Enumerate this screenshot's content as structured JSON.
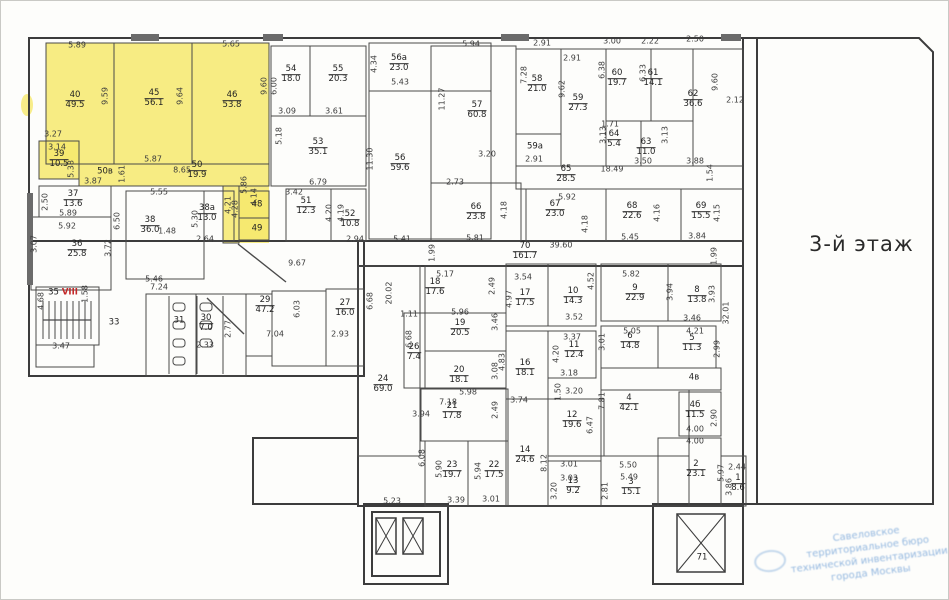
{
  "floor_title": "3-й этаж",
  "stamp": {
    "lines": [
      "Савеловское",
      "территориальное бюро",
      "технической инвентаризации",
      "города Москвы"
    ]
  },
  "highlight_color": "#f6e96d",
  "rooms": [
    {
      "number": "40",
      "area": "49.5",
      "x": 74,
      "y": 100
    },
    {
      "number": "45",
      "area": "56.1",
      "x": 153,
      "y": 98
    },
    {
      "number": "46",
      "area": "53.8",
      "x": 231,
      "y": 100
    },
    {
      "number": "39",
      "area": "10.5",
      "x": 58,
      "y": 159
    },
    {
      "number": "50в",
      "area": "",
      "x": 104,
      "y": 171
    },
    {
      "number": "50",
      "area": "19.9",
      "x": 196,
      "y": 170
    },
    {
      "number": "48",
      "area": "",
      "x": 256,
      "y": 204
    },
    {
      "number": "49",
      "area": "",
      "x": 256,
      "y": 228
    },
    {
      "number": "54",
      "area": "18.0",
      "x": 290,
      "y": 74
    },
    {
      "number": "55",
      "area": "20.3",
      "x": 337,
      "y": 74
    },
    {
      "number": "53",
      "area": "35.1",
      "x": 317,
      "y": 147
    },
    {
      "number": "56а",
      "area": "23.0",
      "x": 398,
      "y": 63
    },
    {
      "number": "56",
      "area": "59.6",
      "x": 399,
      "y": 163
    },
    {
      "number": "57",
      "area": "60.8",
      "x": 476,
      "y": 110
    },
    {
      "number": "58",
      "area": "21.0",
      "x": 536,
      "y": 84
    },
    {
      "number": "59а",
      "area": "",
      "x": 534,
      "y": 146
    },
    {
      "number": "59",
      "area": "27.3",
      "x": 577,
      "y": 103
    },
    {
      "number": "60",
      "area": "19.7",
      "x": 616,
      "y": 78
    },
    {
      "number": "61",
      "area": "14.1",
      "x": 652,
      "y": 78
    },
    {
      "number": "62",
      "area": "36.6",
      "x": 692,
      "y": 99
    },
    {
      "number": "64",
      "area": "5.4",
      "x": 613,
      "y": 139
    },
    {
      "number": "63",
      "area": "11.0",
      "x": 645,
      "y": 147
    },
    {
      "number": "65",
      "area": "28.5",
      "x": 565,
      "y": 174
    },
    {
      "number": "66",
      "area": "23.8",
      "x": 475,
      "y": 212
    },
    {
      "number": "67",
      "area": "23.0",
      "x": 554,
      "y": 209
    },
    {
      "number": "68",
      "area": "22.6",
      "x": 631,
      "y": 211
    },
    {
      "number": "69",
      "area": "15.5",
      "x": 700,
      "y": 211
    },
    {
      "number": "70",
      "area": "161.7",
      "x": 524,
      "y": 251
    },
    {
      "number": "51",
      "area": "12.3",
      "x": 305,
      "y": 206
    },
    {
      "number": "52",
      "area": "10.8",
      "x": 349,
      "y": 219
    },
    {
      "number": "37",
      "area": "13.6",
      "x": 72,
      "y": 199
    },
    {
      "number": "36",
      "area": "25.8",
      "x": 76,
      "y": 249
    },
    {
      "number": "38",
      "area": "36.0",
      "x": 149,
      "y": 225
    },
    {
      "number": "38а",
      "area": "13.0",
      "x": 206,
      "y": 213
    },
    {
      "number": "35",
      "suffix": "VIII",
      "area": "",
      "x": 62,
      "y": 292
    },
    {
      "number": "33",
      "area": "",
      "x": 113,
      "y": 322
    },
    {
      "number": "31",
      "area": "",
      "x": 178,
      "y": 320
    },
    {
      "number": "30",
      "area": "7.0",
      "x": 205,
      "y": 323
    },
    {
      "number": "29",
      "area": "47.2",
      "x": 264,
      "y": 305
    },
    {
      "number": "27",
      "area": "16.0",
      "x": 344,
      "y": 308
    },
    {
      "number": "24",
      "area": "69.0",
      "x": 382,
      "y": 384
    },
    {
      "number": "18",
      "area": "17.6",
      "x": 434,
      "y": 287
    },
    {
      "number": "19",
      "area": "20.5",
      "x": 459,
      "y": 328
    },
    {
      "number": "26",
      "area": "7.4",
      "x": 413,
      "y": 352
    },
    {
      "number": "20",
      "area": "18.1",
      "x": 458,
      "y": 375
    },
    {
      "number": "21",
      "area": "17.8",
      "x": 451,
      "y": 411
    },
    {
      "number": "17",
      "area": "17.5",
      "x": 524,
      "y": 298
    },
    {
      "number": "10",
      "area": "14.3",
      "x": 572,
      "y": 296
    },
    {
      "number": "9",
      "area": "22.9",
      "x": 634,
      "y": 293
    },
    {
      "number": "8",
      "area": "13.8",
      "x": 696,
      "y": 295
    },
    {
      "number": "16",
      "area": "18.1",
      "x": 524,
      "y": 368
    },
    {
      "number": "11",
      "area": "12.4",
      "x": 573,
      "y": 350
    },
    {
      "number": "6",
      "area": "14.8",
      "x": 629,
      "y": 341
    },
    {
      "number": "5",
      "area": "11.3",
      "x": 691,
      "y": 343
    },
    {
      "number": "4в",
      "area": "",
      "x": 693,
      "y": 377
    },
    {
      "number": "4",
      "area": "42.1",
      "x": 628,
      "y": 403
    },
    {
      "number": "4б",
      "area": "11.5",
      "x": 694,
      "y": 410
    },
    {
      "number": "12",
      "area": "19.6",
      "x": 571,
      "y": 420
    },
    {
      "number": "14",
      "area": "24.6",
      "x": 524,
      "y": 455
    },
    {
      "number": "23",
      "area": "19.7",
      "x": 451,
      "y": 470
    },
    {
      "number": "22",
      "area": "17.5",
      "x": 493,
      "y": 470
    },
    {
      "number": "13",
      "area": "9.2",
      "x": 572,
      "y": 486
    },
    {
      "number": "3",
      "area": "15.1",
      "x": 630,
      "y": 487
    },
    {
      "number": "2",
      "area": "23.1",
      "x": 695,
      "y": 469
    },
    {
      "number": "1",
      "area": "8.6",
      "x": 737,
      "y": 483
    },
    {
      "number": "71",
      "area": "",
      "x": 701,
      "y": 557
    }
  ],
  "dimensions": [
    {
      "text": "5.89",
      "x": 76,
      "y": 44,
      "vertical": false
    },
    {
      "text": "5.65",
      "x": 230,
      "y": 43,
      "vertical": false
    },
    {
      "text": "9.59",
      "x": 104,
      "y": 95,
      "vertical": true
    },
    {
      "text": "9.64",
      "x": 179,
      "y": 95,
      "vertical": true
    },
    {
      "text": "9.60",
      "x": 263,
      "y": 85,
      "vertical": true
    },
    {
      "text": "6.00",
      "x": 273,
      "y": 85,
      "vertical": true
    },
    {
      "text": "3.27",
      "x": 52,
      "y": 133,
      "vertical": false
    },
    {
      "text": "3.14",
      "x": 56,
      "y": 146,
      "vertical": false
    },
    {
      "text": "5.38",
      "x": 70,
      "y": 168,
      "vertical": true
    },
    {
      "text": "3.87",
      "x": 92,
      "y": 180,
      "vertical": false
    },
    {
      "text": "1.61",
      "x": 121,
      "y": 173,
      "vertical": true
    },
    {
      "text": "5.87",
      "x": 152,
      "y": 158,
      "vertical": false
    },
    {
      "text": "8.65",
      "x": 181,
      "y": 169,
      "vertical": false
    },
    {
      "text": "5.86",
      "x": 243,
      "y": 184,
      "vertical": true
    },
    {
      "text": "4.14",
      "x": 253,
      "y": 196,
      "vertical": true
    },
    {
      "text": "4.21",
      "x": 227,
      "y": 204,
      "vertical": true
    },
    {
      "text": "4.28",
      "x": 234,
      "y": 208,
      "vertical": true
    },
    {
      "text": "1.48",
      "x": 166,
      "y": 230,
      "vertical": false
    },
    {
      "text": "2.64",
      "x": 204,
      "y": 238,
      "vertical": false
    },
    {
      "text": "2.50",
      "x": 44,
      "y": 201,
      "vertical": true
    },
    {
      "text": "5.89",
      "x": 67,
      "y": 212,
      "vertical": false
    },
    {
      "text": "5.92",
      "x": 66,
      "y": 225,
      "vertical": false
    },
    {
      "text": "3.07",
      "x": 33,
      "y": 243,
      "vertical": true
    },
    {
      "text": "3.72",
      "x": 107,
      "y": 247,
      "vertical": true
    },
    {
      "text": "6.50",
      "x": 116,
      "y": 220,
      "vertical": true
    },
    {
      "text": "5.55",
      "x": 158,
      "y": 191,
      "vertical": false
    },
    {
      "text": "5.30",
      "x": 194,
      "y": 218,
      "vertical": true
    },
    {
      "text": "5.46",
      "x": 153,
      "y": 278,
      "vertical": false
    },
    {
      "text": "9.67",
      "x": 296,
      "y": 262,
      "vertical": false
    },
    {
      "text": "4.68",
      "x": 40,
      "y": 300,
      "vertical": true
    },
    {
      "text": "1.58",
      "x": 84,
      "y": 293,
      "vertical": true
    },
    {
      "text": "7.24",
      "x": 158,
      "y": 286,
      "vertical": false
    },
    {
      "text": "3.47",
      "x": 60,
      "y": 345,
      "vertical": false
    },
    {
      "text": "2.33",
      "x": 204,
      "y": 344,
      "vertical": false
    },
    {
      "text": "2.77",
      "x": 227,
      "y": 328,
      "vertical": true
    },
    {
      "text": "7.04",
      "x": 274,
      "y": 333,
      "vertical": false
    },
    {
      "text": "6.03",
      "x": 296,
      "y": 308,
      "vertical": true
    },
    {
      "text": "2.93",
      "x": 339,
      "y": 333,
      "vertical": false
    },
    {
      "text": "3.09",
      "x": 286,
      "y": 110,
      "vertical": false
    },
    {
      "text": "3.61",
      "x": 333,
      "y": 110,
      "vertical": false
    },
    {
      "text": "5.18",
      "x": 278,
      "y": 135,
      "vertical": true
    },
    {
      "text": "6.79",
      "x": 317,
      "y": 181,
      "vertical": false
    },
    {
      "text": "3.42",
      "x": 293,
      "y": 191,
      "vertical": false
    },
    {
      "text": "4.20",
      "x": 328,
      "y": 212,
      "vertical": true
    },
    {
      "text": "4.19",
      "x": 340,
      "y": 212,
      "vertical": true
    },
    {
      "text": "2.94",
      "x": 354,
      "y": 238,
      "vertical": false
    },
    {
      "text": "5.41",
      "x": 401,
      "y": 238,
      "vertical": false
    },
    {
      "text": "4.34",
      "x": 373,
      "y": 63,
      "vertical": true
    },
    {
      "text": "5.43",
      "x": 399,
      "y": 81,
      "vertical": false
    },
    {
      "text": "5.94",
      "x": 470,
      "y": 43,
      "vertical": false
    },
    {
      "text": "11.27",
      "x": 441,
      "y": 98,
      "vertical": true
    },
    {
      "text": "11.30",
      "x": 369,
      "y": 158,
      "vertical": true
    },
    {
      "text": "3.20",
      "x": 486,
      "y": 153,
      "vertical": false
    },
    {
      "text": "2.73",
      "x": 454,
      "y": 181,
      "vertical": false
    },
    {
      "text": "5.92",
      "x": 566,
      "y": 196,
      "vertical": false
    },
    {
      "text": "2.91",
      "x": 541,
      "y": 42,
      "vertical": false
    },
    {
      "text": "3.00",
      "x": 611,
      "y": 40,
      "vertical": false
    },
    {
      "text": "2.22",
      "x": 649,
      "y": 40,
      "vertical": false
    },
    {
      "text": "2.50",
      "x": 694,
      "y": 38,
      "vertical": false
    },
    {
      "text": "2.91",
      "x": 571,
      "y": 57,
      "vertical": false
    },
    {
      "text": "7.28",
      "x": 523,
      "y": 74,
      "vertical": true
    },
    {
      "text": "9.62",
      "x": 561,
      "y": 88,
      "vertical": true
    },
    {
      "text": "6.38",
      "x": 601,
      "y": 69,
      "vertical": true
    },
    {
      "text": "6.33",
      "x": 642,
      "y": 72,
      "vertical": true
    },
    {
      "text": "9.60",
      "x": 714,
      "y": 81,
      "vertical": true
    },
    {
      "text": "2.91",
      "x": 533,
      "y": 158,
      "vertical": false
    },
    {
      "text": "1.71",
      "x": 609,
      "y": 123,
      "vertical": false
    },
    {
      "text": "3.13",
      "x": 602,
      "y": 134,
      "vertical": true
    },
    {
      "text": "3.13",
      "x": 664,
      "y": 134,
      "vertical": true
    },
    {
      "text": "3.50",
      "x": 642,
      "y": 160,
      "vertical": false
    },
    {
      "text": "3.88",
      "x": 694,
      "y": 160,
      "vertical": false
    },
    {
      "text": "1.54",
      "x": 709,
      "y": 172,
      "vertical": true
    },
    {
      "text": "18.49",
      "x": 611,
      "y": 168,
      "vertical": false
    },
    {
      "text": "5.81",
      "x": 474,
      "y": 237,
      "vertical": false
    },
    {
      "text": "4.18",
      "x": 503,
      "y": 209,
      "vertical": true
    },
    {
      "text": "4.18",
      "x": 584,
      "y": 223,
      "vertical": true
    },
    {
      "text": "5.45",
      "x": 629,
      "y": 236,
      "vertical": false
    },
    {
      "text": "4.16",
      "x": 656,
      "y": 212,
      "vertical": true
    },
    {
      "text": "3.84",
      "x": 696,
      "y": 235,
      "vertical": false
    },
    {
      "text": "4.15",
      "x": 716,
      "y": 212,
      "vertical": true
    },
    {
      "text": "39.60",
      "x": 560,
      "y": 244,
      "vertical": false
    },
    {
      "text": "1.99",
      "x": 431,
      "y": 252,
      "vertical": true
    },
    {
      "text": "1.99",
      "x": 713,
      "y": 255,
      "vertical": true
    },
    {
      "text": "2.12",
      "x": 734,
      "y": 99,
      "vertical": false
    },
    {
      "text": "20.02",
      "x": 388,
      "y": 292,
      "vertical": true
    },
    {
      "text": "6.68",
      "x": 369,
      "y": 300,
      "vertical": true
    },
    {
      "text": "5.17",
      "x": 444,
      "y": 273,
      "vertical": false
    },
    {
      "text": "2.49",
      "x": 491,
      "y": 285,
      "vertical": true
    },
    {
      "text": "3.54",
      "x": 522,
      "y": 276,
      "vertical": false
    },
    {
      "text": "4.97",
      "x": 508,
      "y": 298,
      "vertical": true
    },
    {
      "text": "1.11",
      "x": 408,
      "y": 313,
      "vertical": false
    },
    {
      "text": "5.96",
      "x": 459,
      "y": 311,
      "vertical": false
    },
    {
      "text": "3.46",
      "x": 494,
      "y": 321,
      "vertical": true
    },
    {
      "text": "6.68",
      "x": 408,
      "y": 338,
      "vertical": true
    },
    {
      "text": "3.08",
      "x": 494,
      "y": 370,
      "vertical": true
    },
    {
      "text": "4.83",
      "x": 501,
      "y": 361,
      "vertical": true
    },
    {
      "text": "5.98",
      "x": 467,
      "y": 391,
      "vertical": false
    },
    {
      "text": "7.18",
      "x": 447,
      "y": 401,
      "vertical": false
    },
    {
      "text": "2.49",
      "x": 494,
      "y": 409,
      "vertical": true
    },
    {
      "text": "3.74",
      "x": 518,
      "y": 399,
      "vertical": false
    },
    {
      "text": "5.82",
      "x": 630,
      "y": 273,
      "vertical": false
    },
    {
      "text": "4.52",
      "x": 590,
      "y": 280,
      "vertical": true
    },
    {
      "text": "3.94",
      "x": 669,
      "y": 291,
      "vertical": true
    },
    {
      "text": "3.93",
      "x": 711,
      "y": 293,
      "vertical": true
    },
    {
      "text": "3.46",
      "x": 691,
      "y": 317,
      "vertical": false
    },
    {
      "text": "3.52",
      "x": 573,
      "y": 316,
      "vertical": false
    },
    {
      "text": "3.37",
      "x": 571,
      "y": 336,
      "vertical": false
    },
    {
      "text": "4.20",
      "x": 555,
      "y": 353,
      "vertical": true
    },
    {
      "text": "3.18",
      "x": 568,
      "y": 372,
      "vertical": false
    },
    {
      "text": "3.20",
      "x": 573,
      "y": 390,
      "vertical": false
    },
    {
      "text": "1.50",
      "x": 557,
      "y": 391,
      "vertical": true
    },
    {
      "text": "5.05",
      "x": 631,
      "y": 330,
      "vertical": false
    },
    {
      "text": "3.01",
      "x": 601,
      "y": 341,
      "vertical": true
    },
    {
      "text": "4.21",
      "x": 694,
      "y": 330,
      "vertical": false
    },
    {
      "text": "2.99",
      "x": 716,
      "y": 348,
      "vertical": true
    },
    {
      "text": "32.01",
      "x": 725,
      "y": 312,
      "vertical": true
    },
    {
      "text": "7.81",
      "x": 601,
      "y": 400,
      "vertical": true
    },
    {
      "text": "2.90",
      "x": 713,
      "y": 417,
      "vertical": true
    },
    {
      "text": "4.00",
      "x": 694,
      "y": 428,
      "vertical": false
    },
    {
      "text": "4.00",
      "x": 694,
      "y": 440,
      "vertical": false
    },
    {
      "text": "6.47",
      "x": 589,
      "y": 424,
      "vertical": true
    },
    {
      "text": "3.94",
      "x": 420,
      "y": 413,
      "vertical": false
    },
    {
      "text": "8.12",
      "x": 543,
      "y": 462,
      "vertical": true
    },
    {
      "text": "6.08",
      "x": 421,
      "y": 457,
      "vertical": true
    },
    {
      "text": "5.90",
      "x": 438,
      "y": 468,
      "vertical": true
    },
    {
      "text": "5.94",
      "x": 477,
      "y": 470,
      "vertical": true
    },
    {
      "text": "3.39",
      "x": 455,
      "y": 499,
      "vertical": false
    },
    {
      "text": "3.01",
      "x": 490,
      "y": 498,
      "vertical": false
    },
    {
      "text": "3.01",
      "x": 568,
      "y": 463,
      "vertical": false
    },
    {
      "text": "3.03",
      "x": 568,
      "y": 477,
      "vertical": false
    },
    {
      "text": "3.20",
      "x": 553,
      "y": 490,
      "vertical": true
    },
    {
      "text": "2.81",
      "x": 604,
      "y": 490,
      "vertical": true
    },
    {
      "text": "5.50",
      "x": 627,
      "y": 464,
      "vertical": false
    },
    {
      "text": "5.49",
      "x": 628,
      "y": 476,
      "vertical": false
    },
    {
      "text": "5.97",
      "x": 720,
      "y": 472,
      "vertical": true
    },
    {
      "text": "2.44",
      "x": 736,
      "y": 466,
      "vertical": false
    },
    {
      "text": "3.86",
      "x": 728,
      "y": 486,
      "vertical": true
    },
    {
      "text": "5.23",
      "x": 391,
      "y": 500,
      "vertical": false
    }
  ]
}
